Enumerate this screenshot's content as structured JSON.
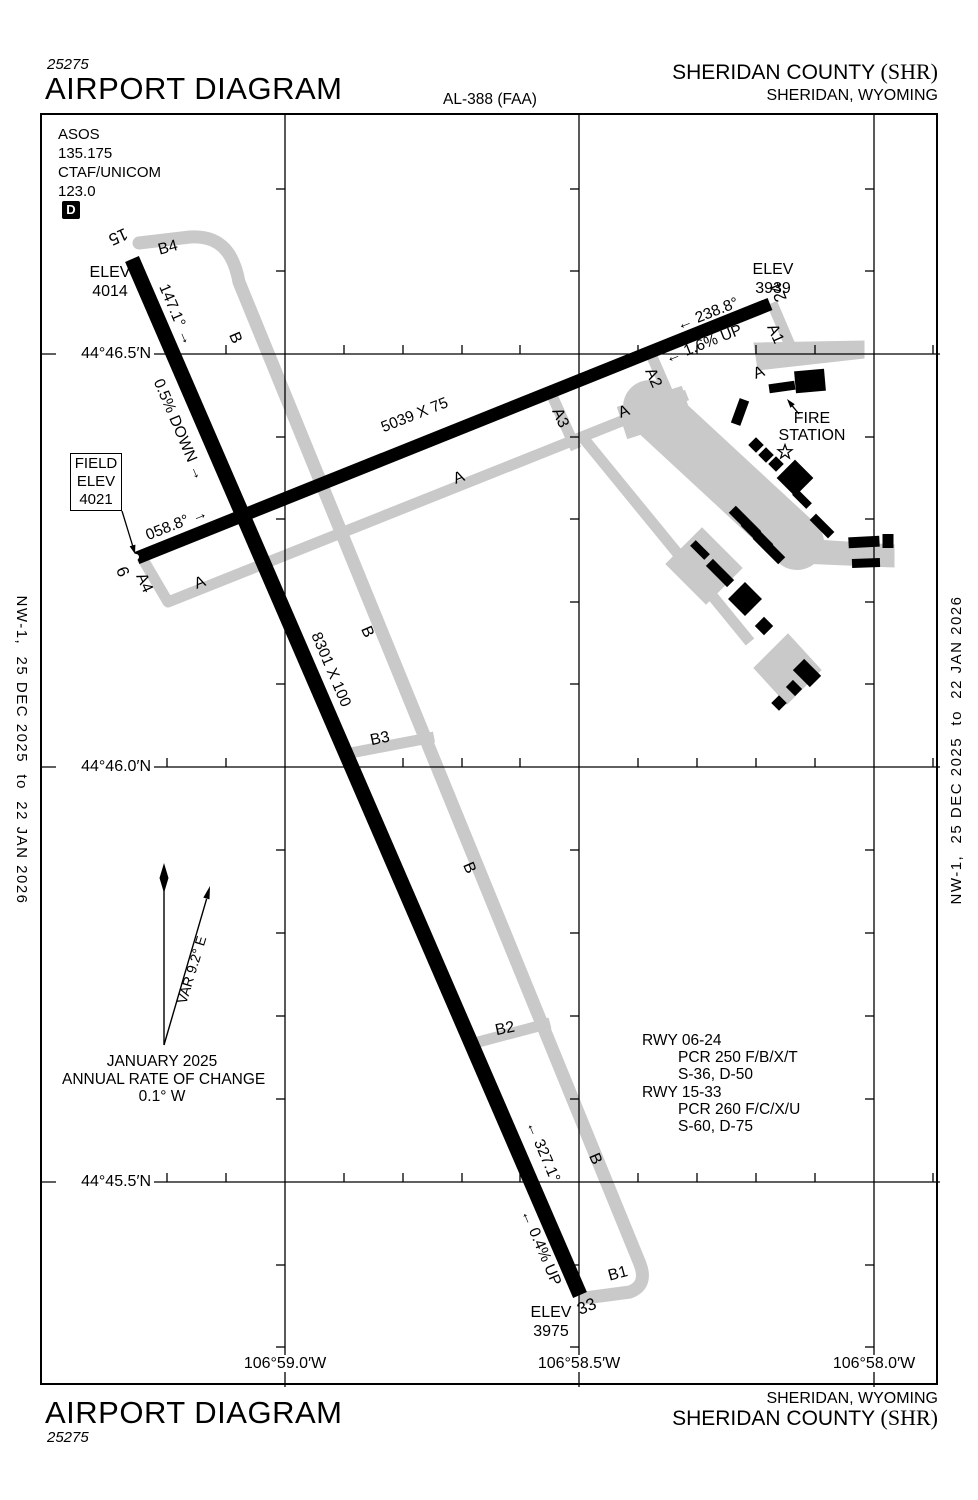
{
  "header": {
    "chart_code": "25275",
    "title": "AIRPORT DIAGRAM",
    "al_number": "AL-388 (FAA)",
    "airport_name": "SHERIDAN COUNTY",
    "airport_id": "(SHR)",
    "city_state": "SHERIDAN, WYOMING"
  },
  "footer": {
    "title": "AIRPORT DIAGRAM",
    "chart_code": "25275",
    "airport_name": "SHERIDAN COUNTY",
    "airport_id": "(SHR)",
    "city_state": "SHERIDAN, WYOMING"
  },
  "edge_note": "NW-1,  25 DEC 2025  to  22 JAN 2026",
  "comms": {
    "asos_label": "ASOS",
    "asos_freq": "135.175",
    "ctaf_label": "CTAF/UNICOM",
    "ctaf_freq": "123.0",
    "d_symbol": "D"
  },
  "field_elev": {
    "l1": "FIELD",
    "l2": "ELEV",
    "l3": "4021"
  },
  "elevations": {
    "rwy15": {
      "label": "ELEV",
      "value": "4014"
    },
    "rwy24": {
      "label": "ELEV",
      "value": "3939"
    },
    "rwy33": {
      "label": "ELEV",
      "value": "3975"
    }
  },
  "runway_15_33": {
    "id_15": "15",
    "id_33": "33",
    "dimensions": "8301 X 100",
    "hdg_15": "147.1° →",
    "hdg_33": "← 327.1°",
    "grade_15": "0.5% DOWN →",
    "grade_33": "← 0.4% UP"
  },
  "runway_06_24": {
    "id_6": "6",
    "id_24": "24",
    "dimensions": "5039 X 75",
    "hdg_06": "058.8° →",
    "hdg_24": "← 238.8°",
    "grade_24": "← 1.6% UP"
  },
  "taxiways": {
    "a": "A",
    "b": "B",
    "a1": "A1",
    "a2": "A2",
    "a3": "A3",
    "a4": "A4",
    "b1": "B1",
    "b2": "B2",
    "b3": "B3",
    "b4": "B4"
  },
  "fire_station": {
    "l1": "FIRE",
    "l2": "STATION"
  },
  "pcr_block": {
    "l1": "RWY 06-24",
    "l2": "PCR 250 F/B/X/T",
    "l3": "S-36, D-50",
    "l4": "RWY 15-33",
    "l5": "PCR 260 F/C/X/U",
    "l6": "S-60, D-75"
  },
  "variation": {
    "var": "VAR 9.2° E",
    "date": "JANUARY 2025",
    "rate_label": "ANNUAL RATE OF CHANGE",
    "rate": "0.1° W"
  },
  "grid": {
    "lat1": "44°46.5′N",
    "lat2": "44°46.0′N",
    "lat3": "44°45.5′N",
    "lon1": "106°59.0′W",
    "lon2": "106°58.5′W",
    "lon3": "106°58.0′W"
  },
  "colors": {
    "pavement_gray": "#c9c9c9",
    "ink": "#000000"
  }
}
